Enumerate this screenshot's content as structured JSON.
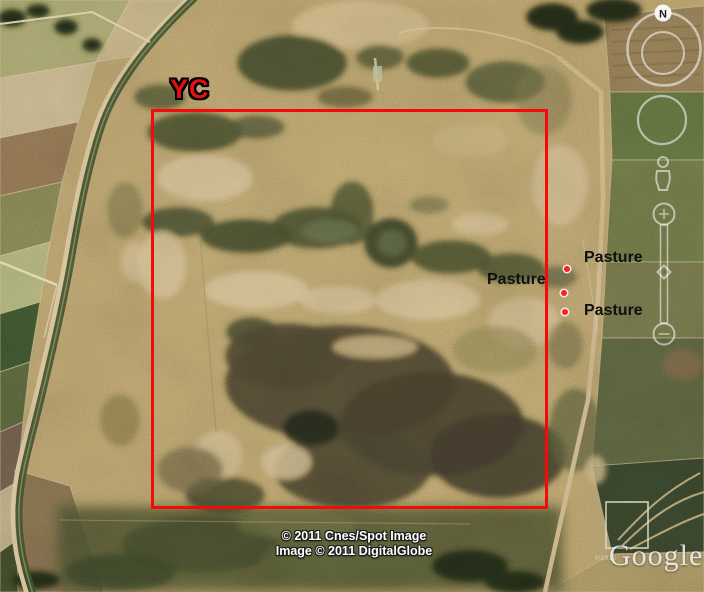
{
  "annotations": {
    "site_label": {
      "text": "YC",
      "color": "#e31010",
      "x": 170,
      "y": 74
    },
    "boundary_rect": {
      "x": 151,
      "y": 109,
      "width": 397,
      "height": 400,
      "color": "#f50a0a"
    },
    "marker_color": "#ff1f1f",
    "label_color": "#101010",
    "markers": [
      {
        "label": "Pasture",
        "label_x": 584,
        "label_y": 249,
        "dot_x": 567,
        "dot_y": 269
      },
      {
        "label": "Pasture",
        "label_x": 487,
        "label_y": 271,
        "dot_x": 564,
        "dot_y": 293
      },
      {
        "label": "Pasture",
        "label_x": 584,
        "label_y": 302,
        "dot_x": 565,
        "dot_y": 312
      }
    ]
  },
  "attribution": {
    "line1": "© 2011 Cnes/Spot Image",
    "line2": "Image © 2011 DigitalGlobe",
    "color": "#ffffff"
  },
  "watermark": {
    "logo": "Google",
    "copyright": "©2010"
  },
  "controls": {
    "north_label": "N"
  },
  "palette": {
    "base_tan": "#b69b68",
    "bright_tan": "#d7bf8d",
    "dark_scrub": "#49502f",
    "swamp_dark": "#3f4629",
    "canal_green": "#3e4d2b",
    "road_light": "#d9c595"
  }
}
